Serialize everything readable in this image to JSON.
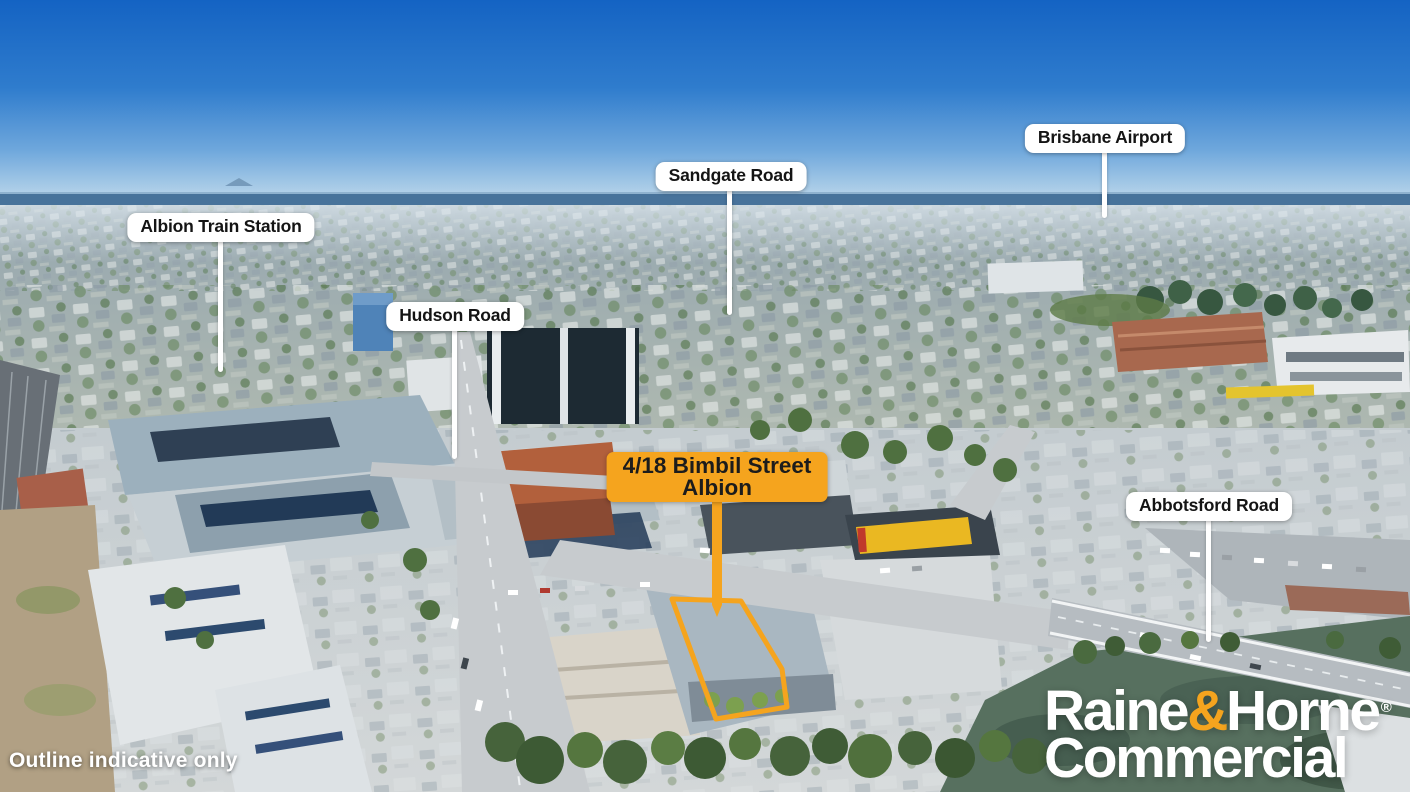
{
  "location_labels": [
    {
      "name": "albion-train-station",
      "text": "Albion Train Station"
    },
    {
      "name": "hudson-road",
      "text": "Hudson Road"
    },
    {
      "name": "sandgate-road",
      "text": "Sandgate Road"
    },
    {
      "name": "brisbane-airport",
      "text": "Brisbane Airport"
    },
    {
      "name": "abbotsford-road",
      "text": "Abbotsford Road"
    }
  ],
  "property_label": {
    "line1": "4/18 Bimbil Street",
    "line2": "Albion"
  },
  "disclaimer": "Outline indicative only",
  "brand": {
    "word1": "Raine",
    "ampersand": "&",
    "word2": "Horne",
    "registered": "®",
    "line2": "Commercial"
  },
  "colors": {
    "accent_orange": "#F5A41E",
    "label_background": "#FFFFFF",
    "label_text": "#141414",
    "brand_text": "#FFFFFF",
    "sky_top": "#1463C3",
    "river_water": "#57705F"
  }
}
